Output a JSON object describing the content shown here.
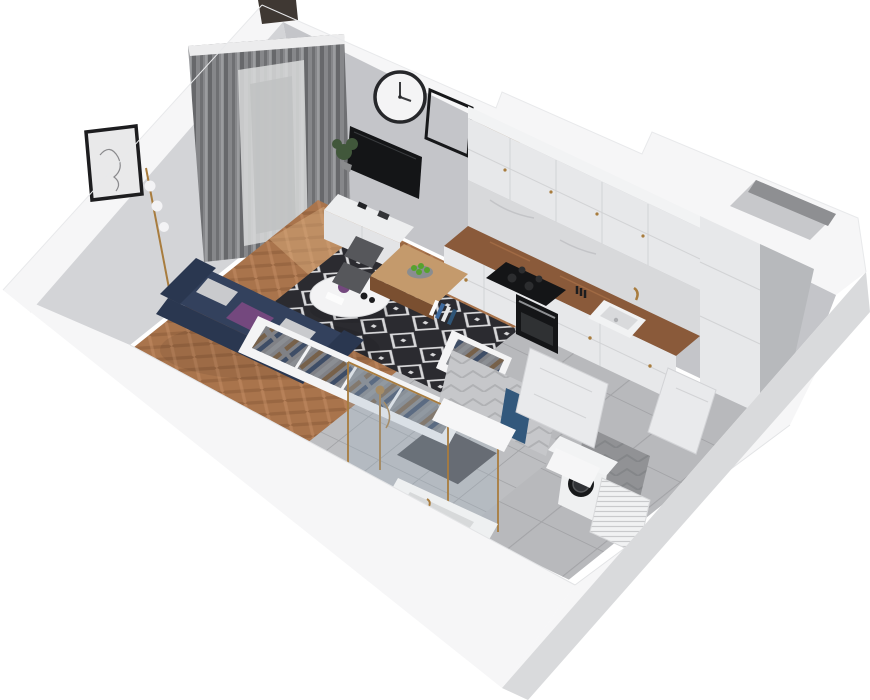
{
  "scene": {
    "label": "3d-isometric-cutaway-floor-plan-of-studio-apartment",
    "view": "top-down isometric cutaway render, white background, no visible text"
  },
  "colors": {
    "wallTop": "#f6f6f7",
    "wallEdge": "#e3e4e6",
    "wallFace": "#c4c5c9",
    "wallFaceL": "#d3d4d7",
    "bevel": "#d9dadc",
    "wood": "#a9744c",
    "woodD": "#8a5a38",
    "woodL": "#c79067",
    "tile": "#b8b9bc",
    "grout": "#a3a4a7",
    "btile": "#bdbec1",
    "rugD": "#2b2b30",
    "rugL": "#d8d8da",
    "sofa": "#33415d",
    "sofaD": "#2a3750",
    "pillow": "#c9cacd",
    "throw": "#74487e",
    "curt": "#86878a",
    "curtD": "#67686b",
    "sheer": "#d9dadb",
    "cab": "#e7e8ea",
    "cabD": "#dcdde0",
    "counter": "#8a5a3a",
    "black": "#141517",
    "brass": "#a87c3e",
    "marble": "#d8d9db",
    "towel": "#32587c",
    "chair": "#56575b",
    "apple": "#56a22e",
    "glass": "#9fb4c2",
    "mat": "#54555a",
    "door": "#e9eaec",
    "plant": "#41573b",
    "frameWood": "#8f6a40",
    "shaft": "#b7b9bc"
  },
  "rooms": {
    "living": {
      "label": "living-room",
      "items": [
        "navy-sofa-with-pillows-and-purple-throw",
        "black-white-diamond-rug",
        "round-white-coffee-table-with-vase",
        "herringbone-wood-floor",
        "gray-curtains-with-sheer-and-balcony-door",
        "wall-clock",
        "line-art-poster",
        "empty-black-frame",
        "wood-framed-mirror",
        "tv-on-wall",
        "white-tv-sideboard",
        "potted-plant",
        "brass-floor-lamp"
      ]
    },
    "kitchen": {
      "label": "kitchen",
      "items": [
        "white-shaker-cabinets-brass-knobs",
        "wood-countertop",
        "marble-backsplash",
        "induction-cooktop",
        "built-in-oven",
        "white-sink-brass-faucet",
        "knife-block",
        "tall-cabinet-column",
        "wood-dining-peninsula",
        "two-gray-chairs",
        "bowl-of-green-apples"
      ]
    },
    "wardrobe": {
      "label": "open-wardrobe",
      "items": [
        "hanging-clothes-on-rails",
        "white-carcass",
        "books-on-top"
      ]
    },
    "bathroom": {
      "label": "bathroom",
      "items": [
        "walk-in-shower-brass-frame-glass",
        "shower-tray",
        "long-white-vanity-basin",
        "dark-floor-mat",
        "blue-towel",
        "chevron-wall-tiles",
        "washing-machine",
        "white-radiator",
        "white-interior-door"
      ]
    },
    "hallway": {
      "label": "hallway",
      "items": [
        "large-gray-floor-tiles",
        "open-entry-door",
        "ventilation-shaft-column"
      ]
    }
  }
}
